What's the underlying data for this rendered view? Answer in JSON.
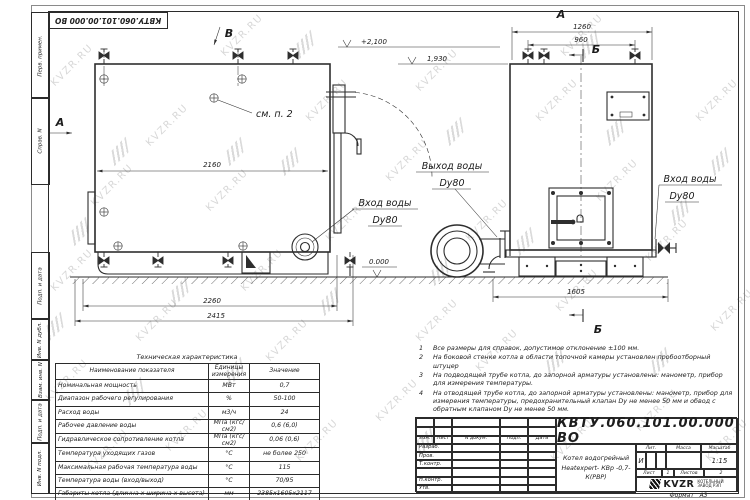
{
  "watermark": {
    "text": "KVZR.RU"
  },
  "frame": {
    "left_labels": [
      "Перв. примен.",
      "Справ. N",
      "Подп. и дата",
      "Инв. N дубл.",
      "Взам. инв. N",
      "Подп. и дата",
      "Инв. N подл."
    ],
    "format_label": "Формат",
    "format_value": "А3"
  },
  "drawing": {
    "view_arrow_b": "В",
    "view_arrow_a": "А",
    "section_mark_b": "Б",
    "see_note_label": "см. п. 2",
    "level_plus_2100": "+2,100",
    "level_1930": "1,930",
    "level_zero": "0.000",
    "dim_2160": "2160",
    "dim_2260": "2260",
    "dim_2415": "2415",
    "dim_1260": "1260",
    "dim_960": "960",
    "dim_1605": "1605",
    "water_outlet_label": "Выход воды",
    "water_inlet_label": "Вход воды",
    "dy80": "Dy80"
  },
  "notes": {
    "items": [
      {
        "num": "1",
        "text": "Все размеры для справок, допустимое отклонение ±100 мм."
      },
      {
        "num": "2",
        "text": "На боковой стенке котла в области топочной камеры установлен пробоотборный штуцер"
      },
      {
        "num": "3",
        "text": "На  подводящей трубе котла, до запорной арматуры установлены: манометр, прибор для измерения температуры."
      },
      {
        "num": "4",
        "text": "На отводящей трубе котла, до запорной арматуры установлены: манометр, прибор для измерения температуры, предохранительный клапан Dу не менее 50 мм и обвод с обратным клапаном Dу не менее 50 мм."
      }
    ]
  },
  "tech_table": {
    "title": "Техническая характеристика",
    "headers": [
      "Наименование показателя",
      "Единицы измерения",
      "Значение"
    ],
    "rows": [
      [
        "Номинальная мощность",
        "МВт",
        "0,7"
      ],
      [
        "Диапазон рабочего регулирования",
        "%",
        "50-100"
      ],
      [
        "Расход воды",
        "м3/ч",
        "24"
      ],
      [
        "Рабочее давление воды",
        "МПа (кгс/см2)",
        "0,6 (6,0)"
      ],
      [
        "Гидравлическое сопротивление котла",
        "МПа (кгс/см2)",
        "0,06 (0,6)"
      ],
      [
        "Температура уходящих газов",
        "°С",
        "не более 250"
      ],
      [
        "Максимальная рабочая температура воды",
        "°С",
        "115"
      ],
      [
        "Температура воды (вход/выход)",
        "°С",
        "70/95"
      ],
      [
        "Габариты котла (длинна х ширина х высота)",
        "мм",
        "2385х1605х2117"
      ]
    ]
  },
  "title_block": {
    "doc_number": "КВТУ.060.101.00.000 ВО",
    "product_name_line1": "Котел водогрейный",
    "product_name_line2": "Heatexpert- КВр -0,7- К(РВР)",
    "col_izm": "Изм.",
    "col_list": "Лист",
    "col_doc": "N докум.",
    "col_sign": "Подп.",
    "col_date": "Дата",
    "row_labels": [
      "Разраб.",
      "Пров.",
      "Т.контр.",
      "",
      "Н.контр.",
      "Утв."
    ],
    "lit_header": "Лит.",
    "mass_header": "Масса",
    "scale_header": "Масштаб",
    "lit": "И",
    "scale": "1:15",
    "sheet_label": "Лист",
    "sheet": "1",
    "sheets_label": "Листов",
    "sheets": "2",
    "company_short": "KVZR",
    "company_line1": "КОТЕЛЬНЫЙ",
    "company_line2": "ЗАВОД РЭП"
  }
}
